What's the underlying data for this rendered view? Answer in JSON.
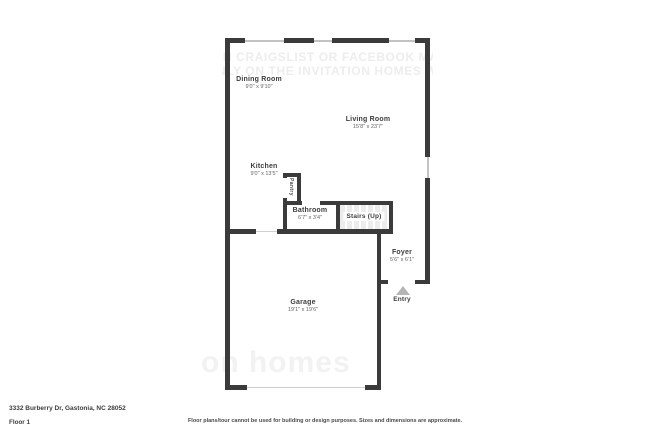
{
  "meta": {
    "address": "3332 Burberry Dr, Gastonia, NC 28052",
    "floor_label": "Floor 1",
    "disclaimer": "Floor plans/tour cannot be used for building or design purposes. Sizes and dimensions are approximate."
  },
  "watermarks": {
    "top_line1": "ON CRAIGSLIST OR FACEBOOK MARK",
    "top_line2": "NLY ON THE INVITATION HOMES WE",
    "bottom": "on homes"
  },
  "rooms": [
    {
      "name": "Dining Room",
      "dims": "9'0\" x 9'10\""
    },
    {
      "name": "Living Room",
      "dims": "15'8\" x 23'7\""
    },
    {
      "name": "Kitchen",
      "dims": "9'0\" x 13'5\""
    },
    {
      "name": "Pantry",
      "dims": ""
    },
    {
      "name": "Bathroom",
      "dims": "6'7\" x 3'4\""
    },
    {
      "name": "Stairs (Up)",
      "dims": ""
    },
    {
      "name": "Foyer",
      "dims": "5'6\" x 6'1\""
    },
    {
      "name": "Garage",
      "dims": "19'1\" x 19'6\""
    },
    {
      "name": "Entry",
      "dims": ""
    }
  ],
  "colors": {
    "wall": "#3b3b3b",
    "window_line": "#c2c2c2",
    "door_line": "#cfcfcf",
    "entry_arrow": "#b5b5b5",
    "room_text": "#3d3d3d",
    "dims_text": "#666666",
    "watermark": "#ededed",
    "stairs_bg": "#ececec"
  }
}
